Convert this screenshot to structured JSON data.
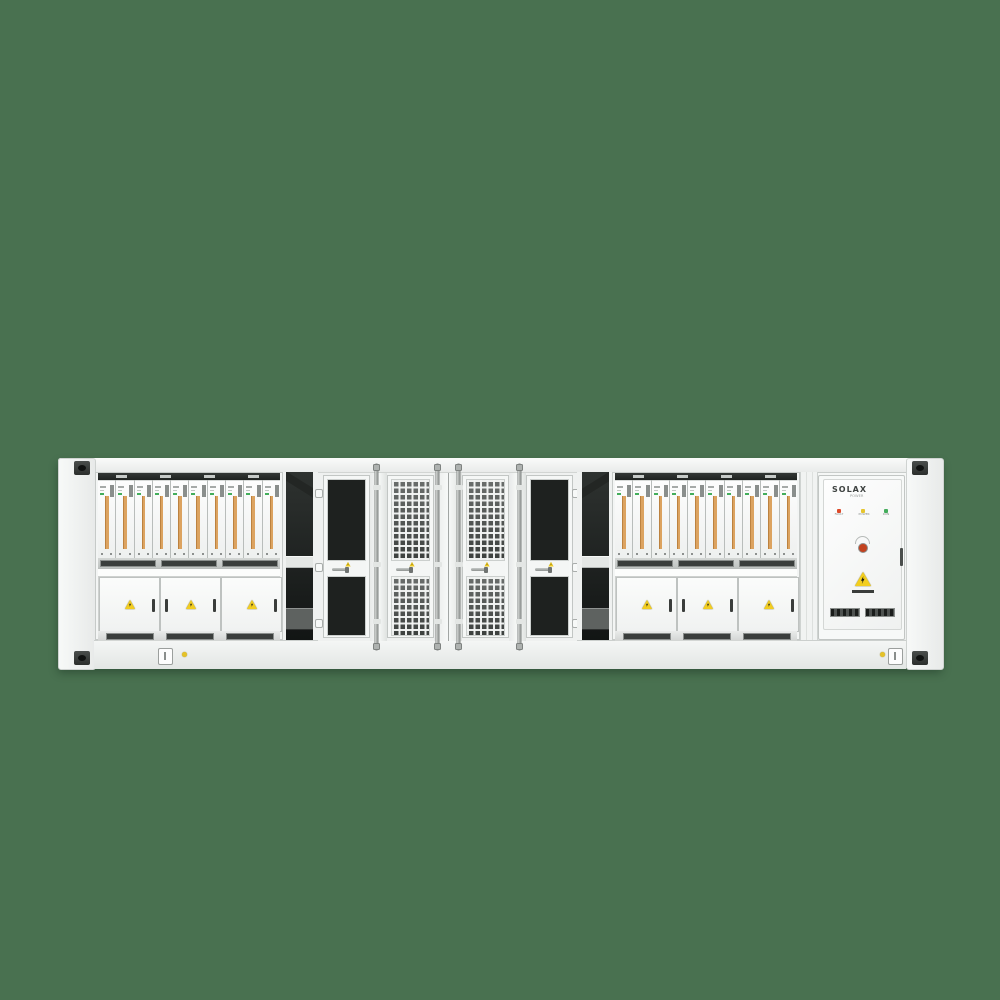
{
  "background_color": "#497150",
  "scene": "front view of white containerized battery energy storage system on green background",
  "container": {
    "frame": {
      "color": "#F2F4F3",
      "corner_castings": 4
    },
    "left_rack": {
      "label": "PCS Distribution Cabinet",
      "module_count": 10,
      "module_stripe_color": "#DCA360",
      "status_led_color": "#43AD5B",
      "door_count": 3,
      "door_warning_icon": "warning-triangle"
    },
    "right_rack": {
      "label": "PCS Distribution Cabinet",
      "module_count": 10,
      "module_stripe_color": "#DCA360",
      "status_led_color": "#43AD5B",
      "door_count": 3,
      "door_warning_icon": "warning-triangle"
    },
    "mesh_bay": {
      "door_count": 4,
      "locking_rod_count": 4,
      "door_warning_icon": "warning-triangle"
    },
    "solax_cabinet": {
      "brand": "SOLAX",
      "brand_sub": "POWER",
      "indicators": [
        {
          "label": "FAULT",
          "color": "#DD4A2A"
        },
        {
          "label": "POWER",
          "color": "#E6C52E"
        },
        {
          "label": "RUN",
          "color": "#44AD5C"
        }
      ],
      "estop_color": "#C2421F",
      "warning_icon": "high-voltage-triangle"
    },
    "bottom_rail": {
      "indicator_dot_color": "#E5C228",
      "switch_plates": 2
    }
  }
}
